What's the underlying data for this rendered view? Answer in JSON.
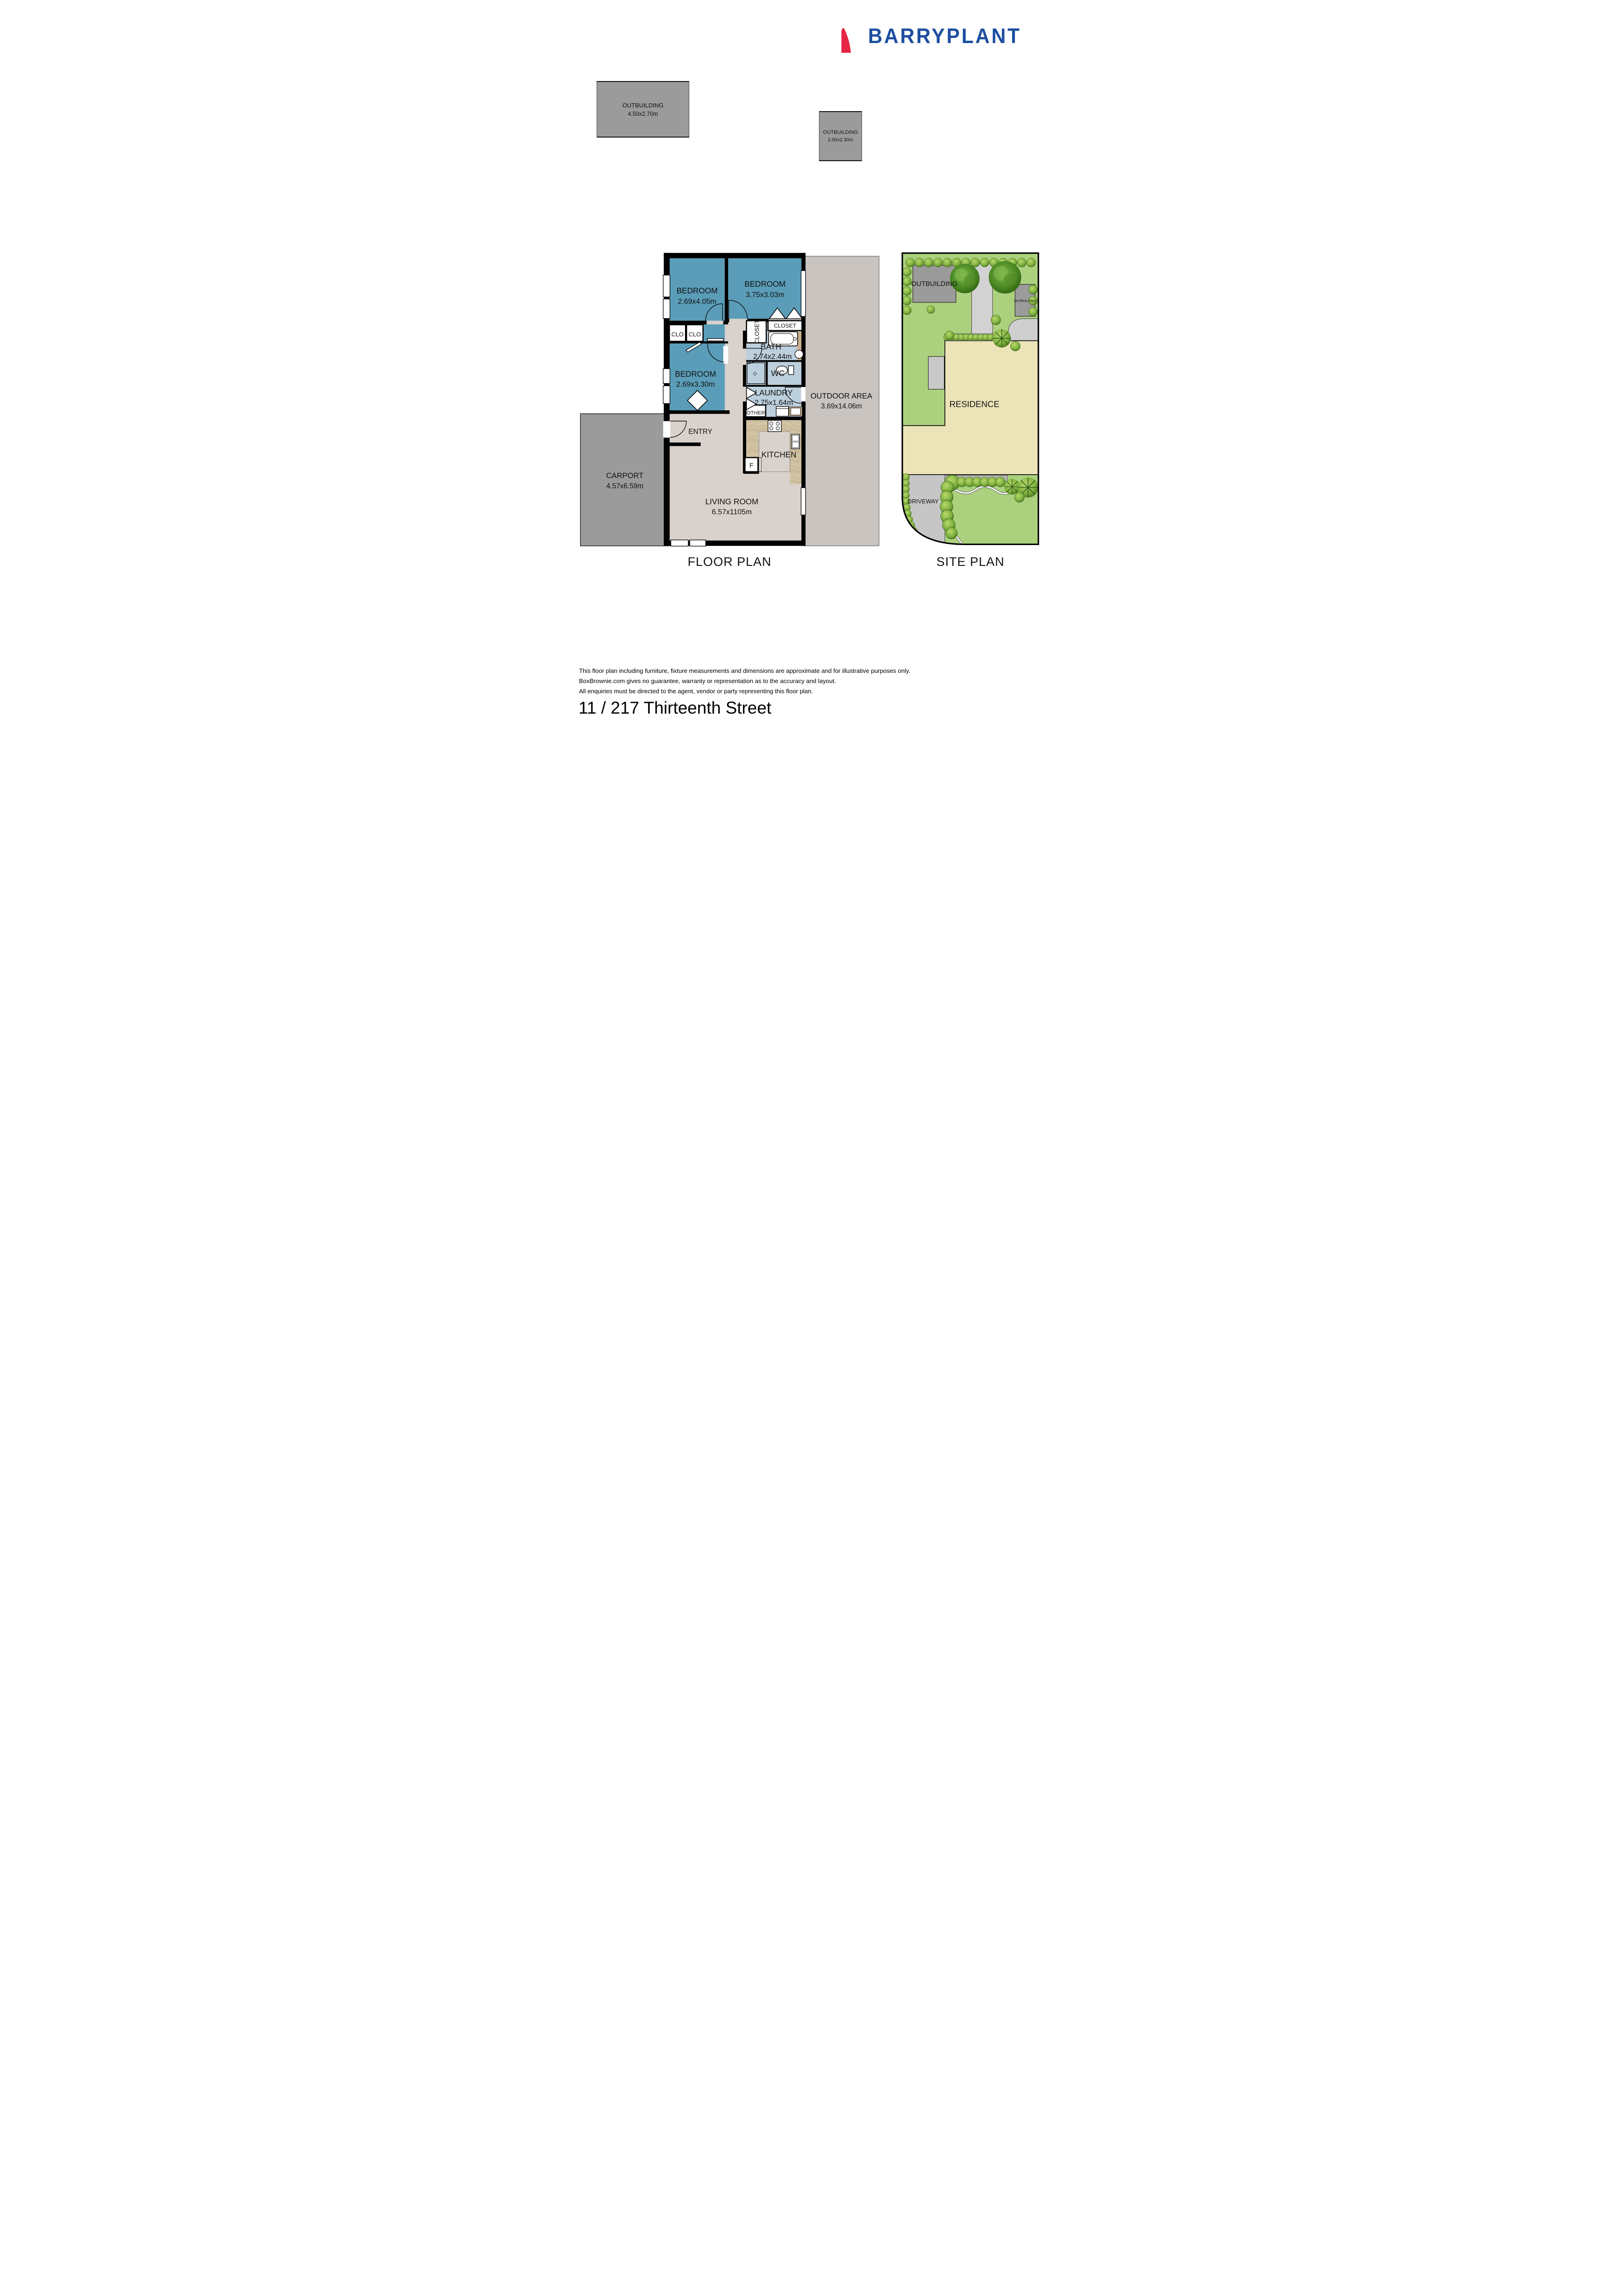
{
  "brand": {
    "name": "BARRYPLANT",
    "sail_red": "#e62643",
    "text_blue": "#1d4fa0"
  },
  "outbuildings": [
    {
      "label": "OUTBUILDING",
      "dims": "4.50x2.70m"
    },
    {
      "label": "OUTBUILDING",
      "dims": "2.00x2.30m"
    }
  ],
  "floor_plan": {
    "title": "FLOOR PLAN",
    "rooms": {
      "bedroom1": {
        "label": "BEDROOM",
        "dims": "2.69x4.05m"
      },
      "bedroom2": {
        "label": "BEDROOM",
        "dims": "3.75x3.03m"
      },
      "bedroom3": {
        "label": "BEDROOM",
        "dims": "2.69x3.30m"
      },
      "bath": {
        "label": "BATH",
        "dims": "2.74x2.44m"
      },
      "wc": {
        "label": "WC"
      },
      "laundry": {
        "label": "LAUNDRY",
        "dims": "2.75x1.64m"
      },
      "kitchen": {
        "label": "KITCHEN"
      },
      "living": {
        "label": "LIVING ROOM",
        "dims": "6.57x1105m"
      },
      "entry": {
        "label": "ENTRY"
      },
      "carport": {
        "label": "CARPORT",
        "dims": "4.57x6.59m"
      },
      "outdoor": {
        "label": "OUTDOOR AREA",
        "dims": "3.69x14.06m"
      },
      "closet_upper": {
        "label": "CLOSET"
      },
      "closet_lower": {
        "label": "CLOSET"
      },
      "clo_left": {
        "label": "CLO"
      },
      "clo_right": {
        "label": "CLO"
      },
      "other": {
        "label": "OTHER"
      },
      "fridge": {
        "label": "F"
      }
    },
    "colors": {
      "bedroom": "#5b9db8",
      "wet_area": "#bccfdd",
      "floor": "#d9d1cc",
      "kitchen_bench": "#cbb18d",
      "carport": "#9b9b9b",
      "outdoor": "#c9c4c0",
      "wall": "#000000"
    }
  },
  "site_plan": {
    "title": "SITE PLAN",
    "labels": {
      "outbuilding_top": "OUTBUILDING",
      "outbuilding_right": "OUTBUILDING",
      "residence": "RESIDENCE",
      "driveway": "DRIVEWAY"
    },
    "colors": {
      "lawn": "#acd17e",
      "residence": "#ece3b8",
      "paving": "#c9c9c9"
    }
  },
  "footer": {
    "disclaimer": [
      "This floor plan including furniture, fixture measurements and dimensions are approximate and for illustrative purposes only.",
      "BoxBrownie.com gives no guarantee, warranty or representation as to the accuracy and layout.",
      "All enquiries must be directed to the agent, vendor or party representing this floor plan."
    ],
    "address": "11 / 217 Thirteenth Street"
  }
}
